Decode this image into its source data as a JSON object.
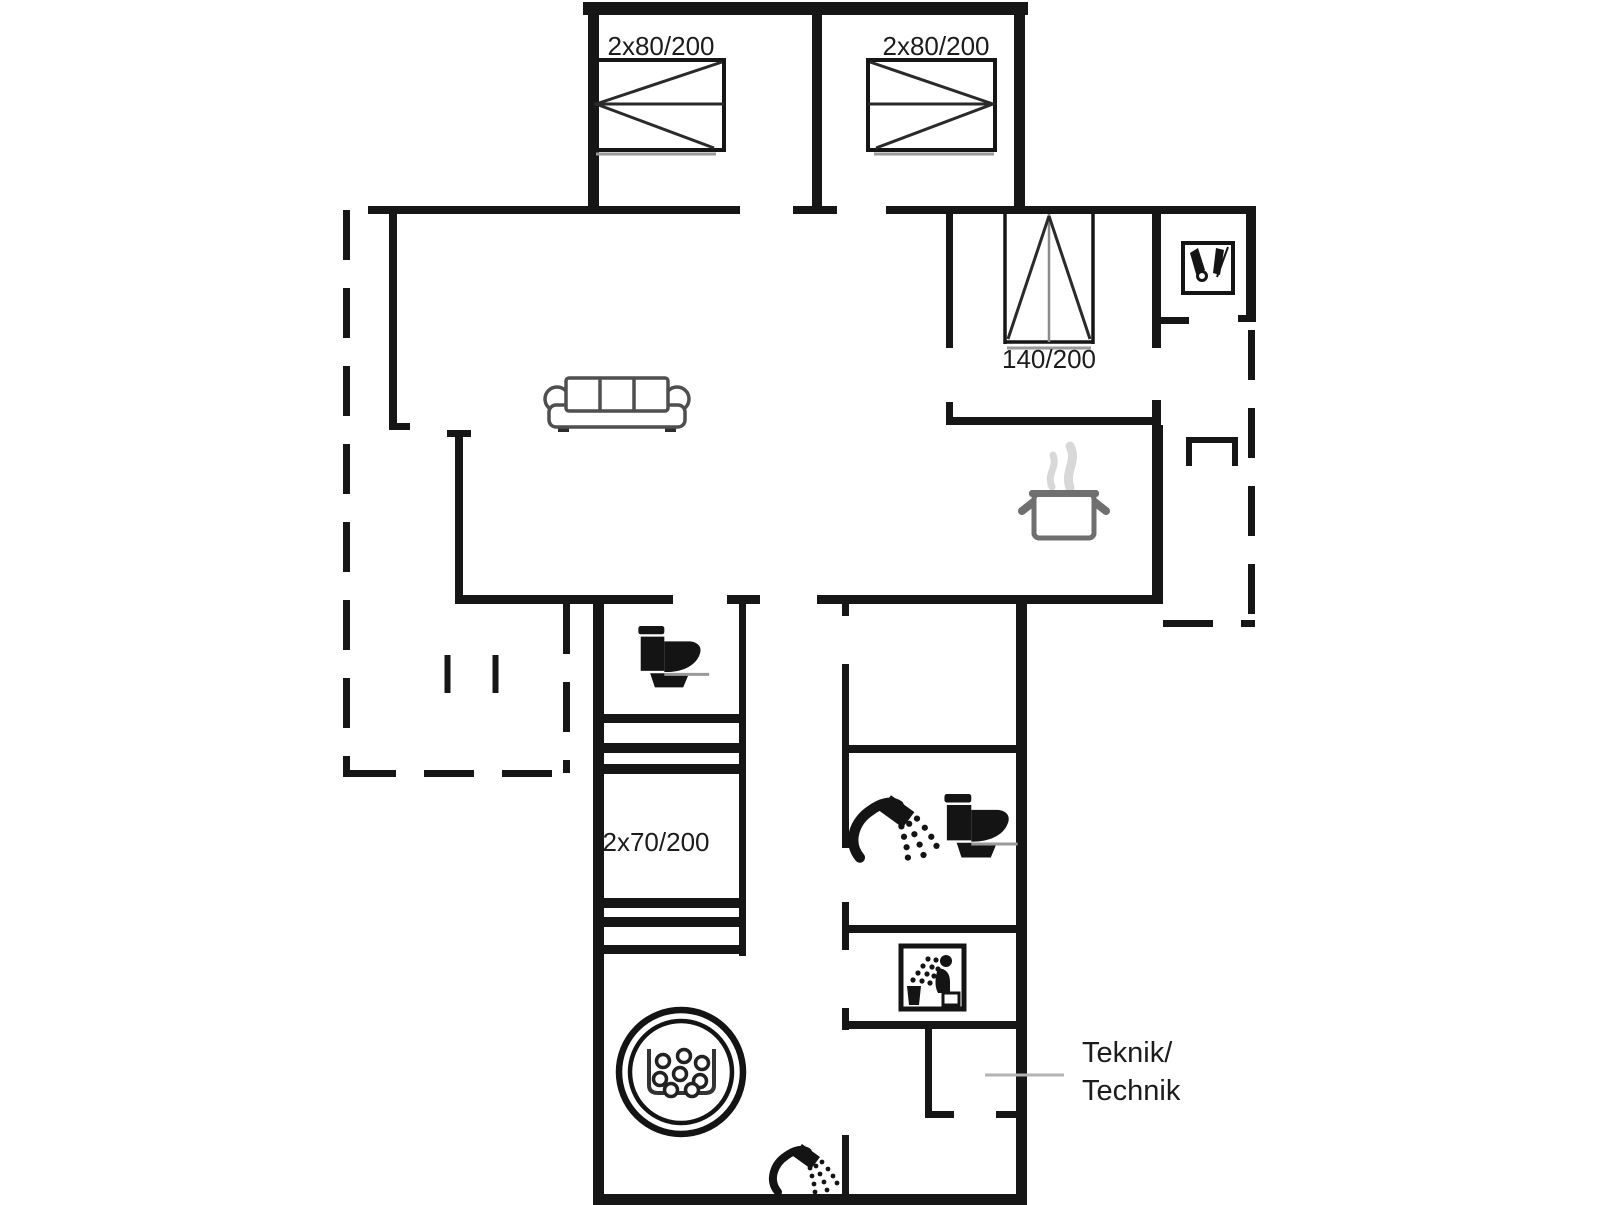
{
  "floor_plan": {
    "dimension_labels": {
      "left_bedroom_bed": "2x80/200",
      "right_bedroom_bed": "2x80/200",
      "small_bedroom_bed": "140/200",
      "bunk_bedroom_beds": "2x70/200"
    },
    "annotations": {
      "technical_room_line1": "Teknik/",
      "technical_room_line2": "Technik"
    },
    "colors": {
      "walls": "#161616",
      "text": "#1c1c1c",
      "furniture_outline": "#4f4f4f",
      "pot_outline": "#6f6f6f",
      "steam": "#d8d8d8",
      "leader_line": "#b3b3b3",
      "background": "#ffffff"
    },
    "fixtures": [
      "double-bed-icon",
      "double-bed-icon",
      "single-bed-icon",
      "sofa-icon",
      "cooking-pot-icon",
      "toilet-icon",
      "toilet-icon",
      "shower-icon",
      "shower-icon",
      "sauna-icon",
      "wardrobe-icon",
      "hot-tub-icon",
      "bunk-bed-icon",
      "bunk-bed-icon"
    ]
  }
}
